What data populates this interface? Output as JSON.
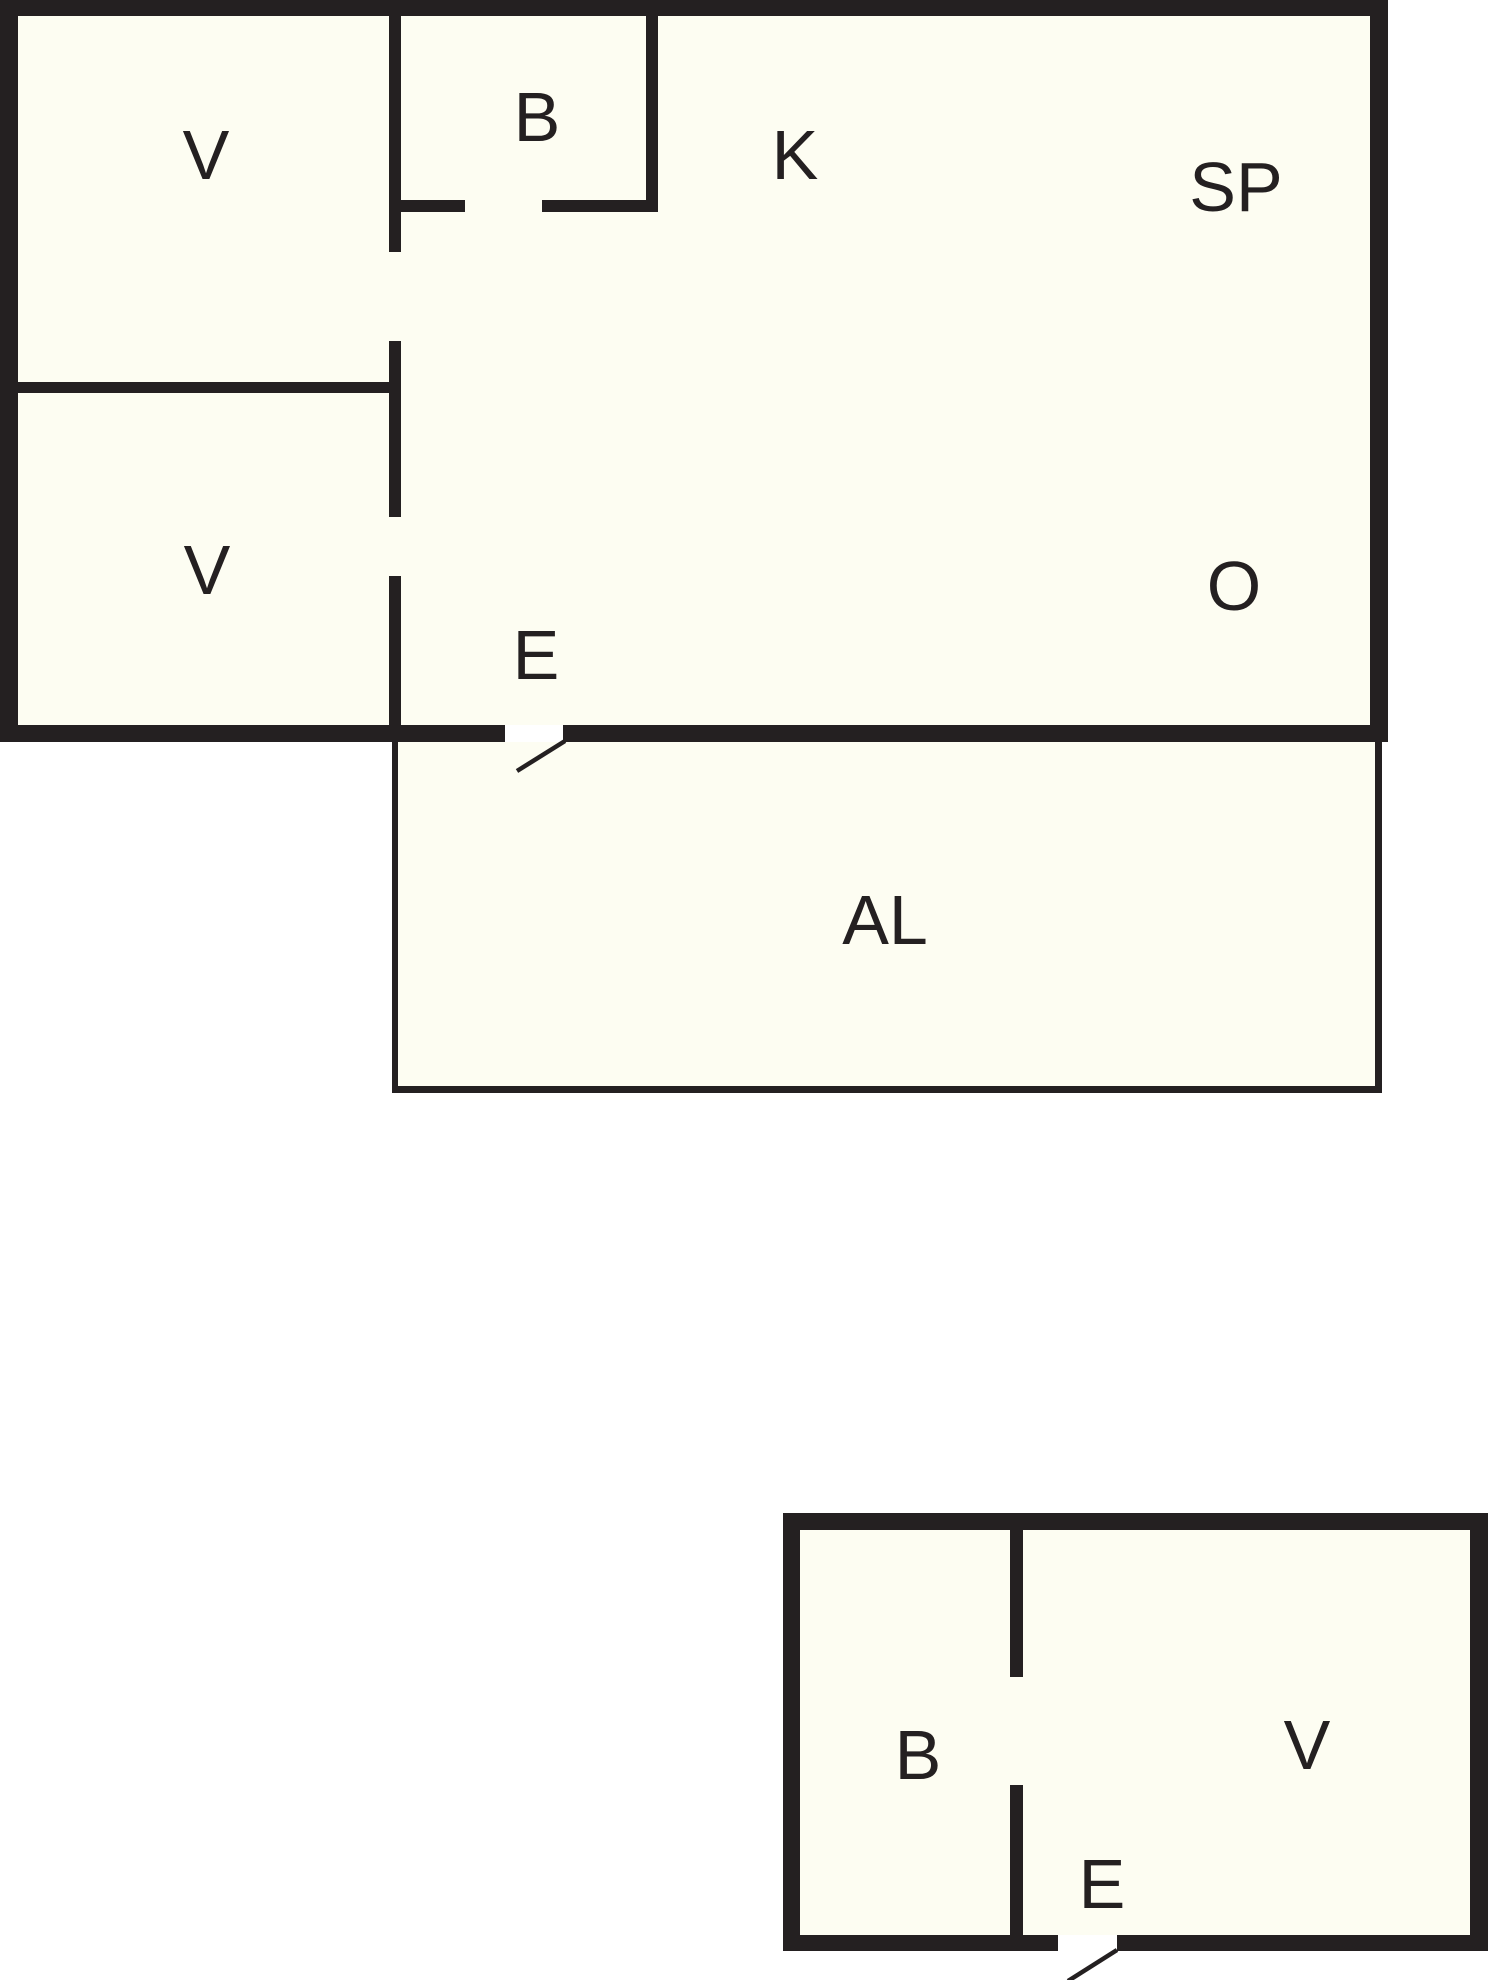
{
  "colors": {
    "background": "#ffffff",
    "room_fill": "#fdfdf2",
    "wall": "#242021"
  },
  "labels": [
    {
      "id": "room-v-top-left",
      "text": "V",
      "x": 206,
      "y": 155
    },
    {
      "id": "room-b-main",
      "text": "B",
      "x": 537,
      "y": 117
    },
    {
      "id": "room-k",
      "text": "K",
      "x": 795,
      "y": 155
    },
    {
      "id": "room-sp",
      "text": "SP",
      "x": 1236,
      "y": 187
    },
    {
      "id": "room-v-bottom-left",
      "text": "V",
      "x": 207,
      "y": 570
    },
    {
      "id": "entrance-main",
      "text": "E",
      "x": 536,
      "y": 655
    },
    {
      "id": "room-o",
      "text": "O",
      "x": 1234,
      "y": 586
    },
    {
      "id": "area-al",
      "text": "AL",
      "x": 885,
      "y": 920
    },
    {
      "id": "room-b-annex",
      "text": "B",
      "x": 918,
      "y": 1755
    },
    {
      "id": "room-v-annex",
      "text": "V",
      "x": 1307,
      "y": 1745
    },
    {
      "id": "entrance-annex",
      "text": "E",
      "x": 1102,
      "y": 1884
    }
  ]
}
